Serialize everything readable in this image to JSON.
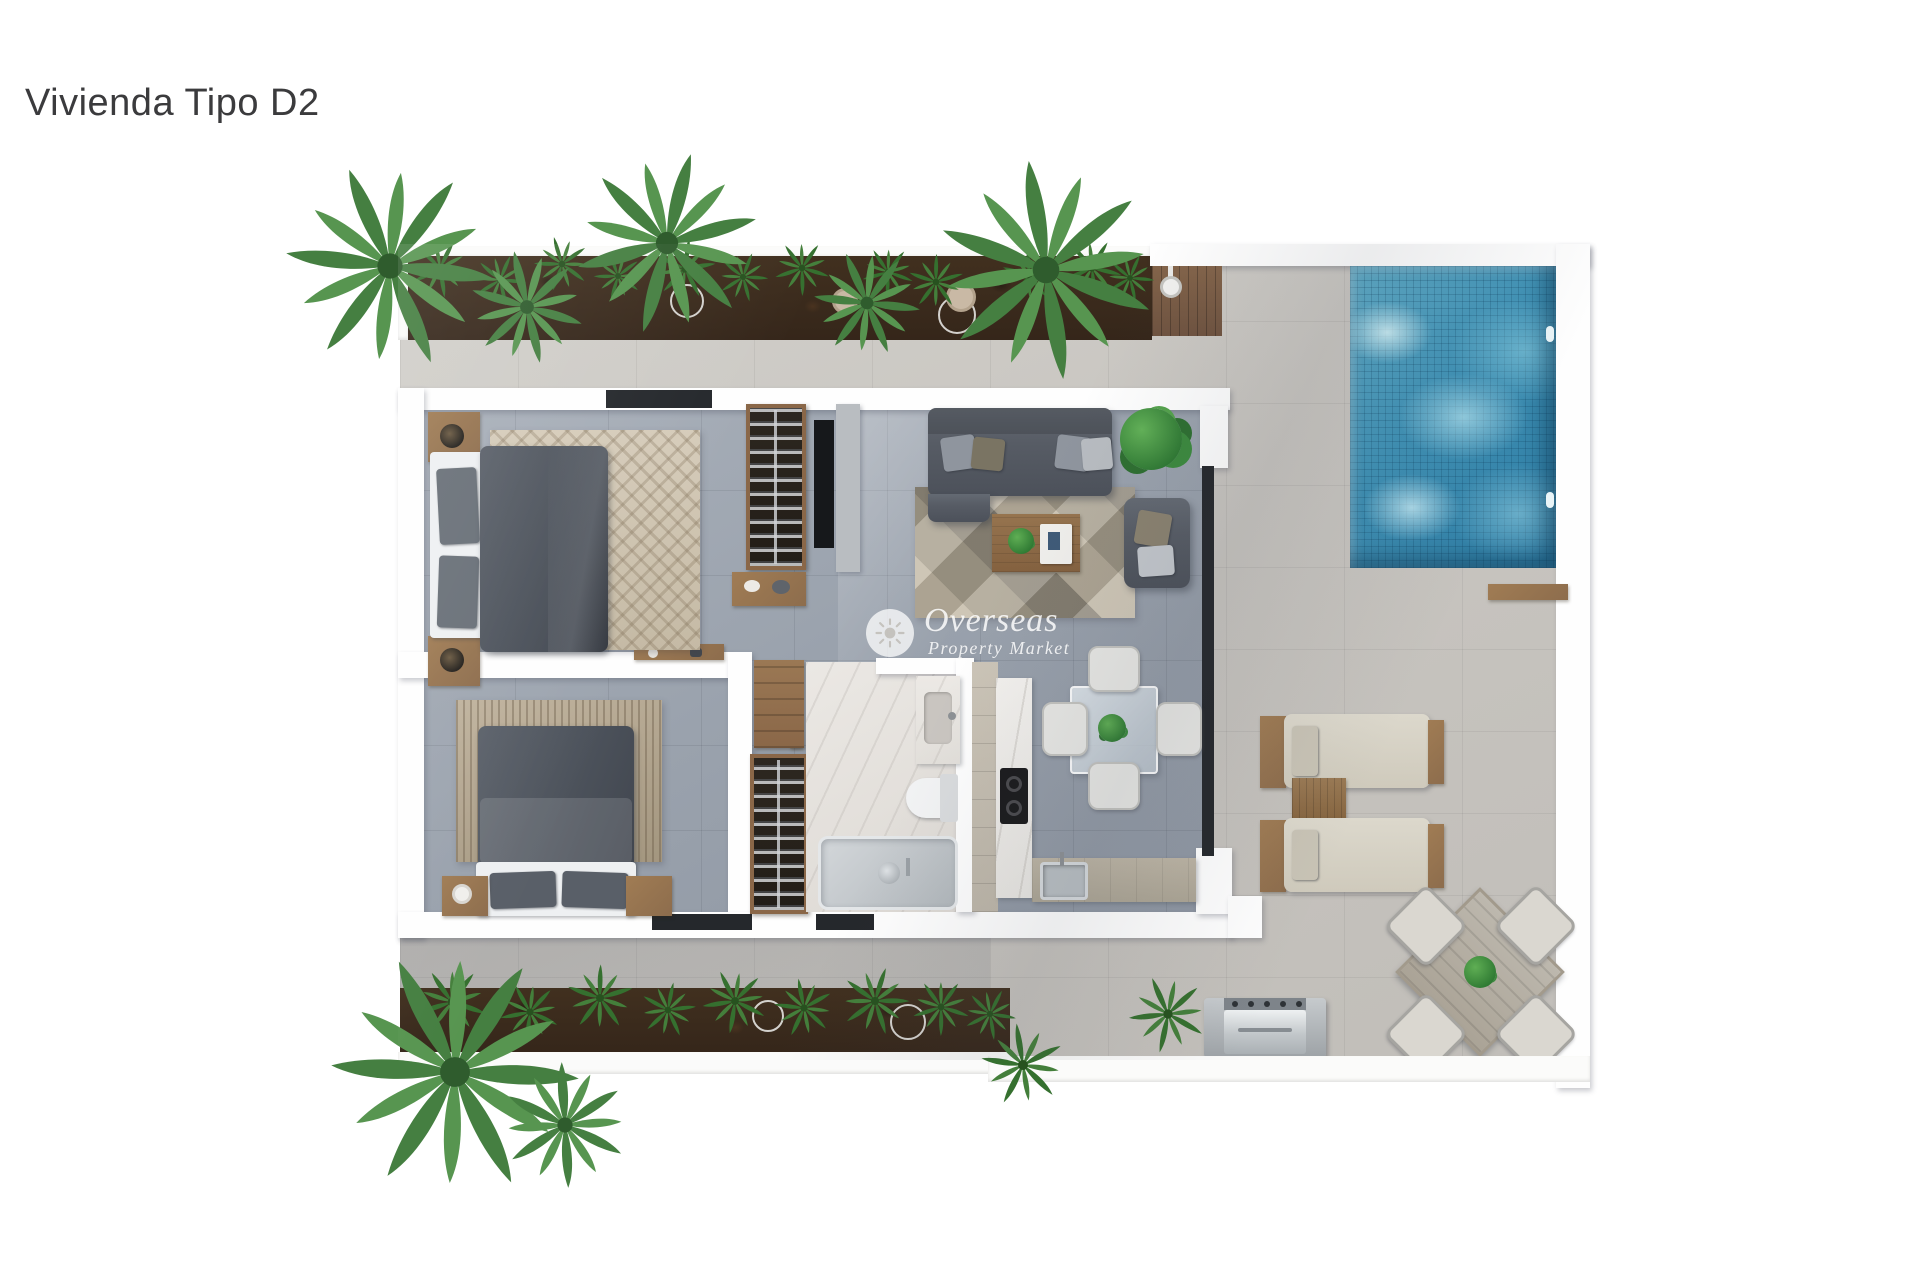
{
  "page": {
    "title": "Vivienda Tipo D2",
    "background": "#ffffff",
    "title_color": "#3b3b3d"
  },
  "watermark": {
    "brand": "Overseas",
    "tagline": "Property Market",
    "icon": "sun-icon",
    "color": "#ffffff"
  },
  "palette": {
    "terrace_tile": "#c8c5c0",
    "interior_tile": "#9aa2ad",
    "wall_white": "#fefefe",
    "pool_water": "#3e90b4",
    "pool_caustic": "#cdeef5",
    "planter_soil": "#38281d",
    "plant_green": "#4c8a4a",
    "fern_green": "#35702f",
    "wood": "#8f6f4f",
    "deck_wood": "#7a5c43",
    "upholstery_dark": "#565b63",
    "rug_beige": "#c6bba7",
    "marble": "#e9e6e2",
    "cooktop_black": "#1b1b1d",
    "stainless": "#c2c7ca",
    "door_dark": "#25282c"
  }
}
